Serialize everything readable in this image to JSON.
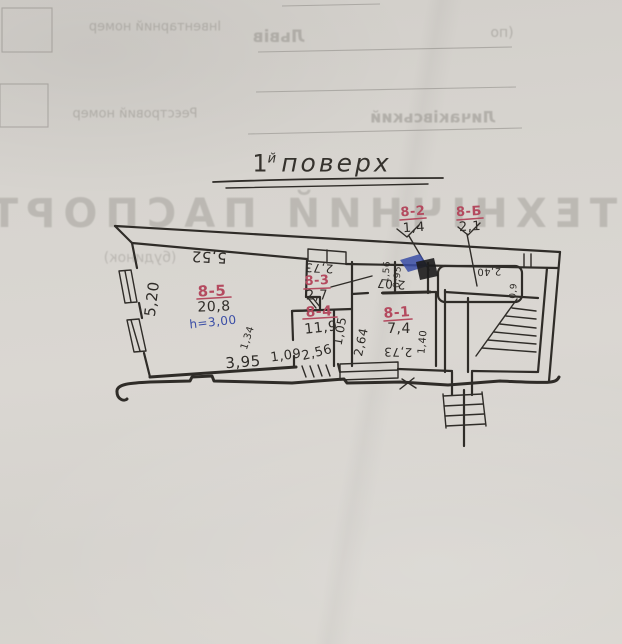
{
  "document": {
    "ghost": {
      "heading": "ТЕХНІЧНИЙ ПАСПОРТ",
      "subtitle": "(будинок)",
      "field_inventory": "Інвентарний номер",
      "field_registry": "Реєстровий номер",
      "city": "Львів",
      "district": "Личаківський",
      "paren": "(по"
    },
    "title_parts": {
      "num": "1",
      "sup": "й",
      "word": "поверх"
    },
    "plan": {
      "rooms": [
        {
          "label": "8-5",
          "area": "20,8",
          "height": "h=3,00"
        },
        {
          "label": "8-3",
          "area": "2,7"
        },
        {
          "label": "8-4",
          "area": "11,9"
        },
        {
          "label": "8-1",
          "area": "7,4"
        },
        {
          "label": "8-2",
          "area": "1,4"
        },
        {
          "label": "8-Б",
          "area": "2,1"
        }
      ],
      "measurements": {
        "m552": "5,52",
        "m520": "5,20",
        "m395": "3,95",
        "m134": "1,34",
        "m109": "1,09",
        "m256": "2,56",
        "m273a": "2,73",
        "m105": "1,05",
        "m264": "2,64",
        "m207": "2,07",
        "m273b": "2,73",
        "m140": "1,40",
        "m156": "1,56",
        "m095": "0,95",
        "m240": "2,40",
        "m09": "0,9"
      },
      "colors": {
        "ink": "#2f2c28",
        "red": "#b44a5f",
        "blue": "#3a4da6",
        "ghost": "#96938d"
      }
    }
  }
}
